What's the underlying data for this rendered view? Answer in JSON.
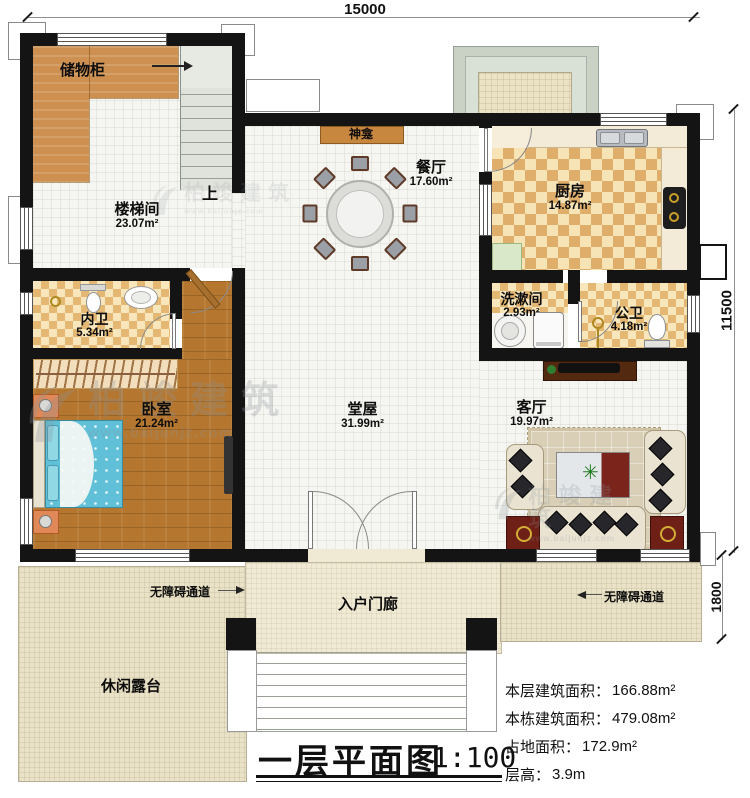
{
  "dimensions": {
    "top": "15000",
    "right": "11500",
    "porch_depth": "1800"
  },
  "rooms": {
    "storage": {
      "name": "储物柜"
    },
    "stairwell": {
      "name": "楼梯间",
      "area": "23.07m²"
    },
    "shrine": {
      "name": "神龛"
    },
    "dining": {
      "name": "餐厅",
      "area": "17.60m²"
    },
    "kitchen": {
      "name": "厨房",
      "area": "14.87m²"
    },
    "washroom": {
      "name": "洗漱间",
      "area": "2.93m²"
    },
    "public_bath": {
      "name": "公卫",
      "area": "4.18m²"
    },
    "private_bath": {
      "name": "内卫",
      "area": "5.34m²"
    },
    "bedroom": {
      "name": "卧室",
      "area": "21.24m²"
    },
    "hall": {
      "name": "堂屋",
      "area": "31.99m²"
    },
    "living": {
      "name": "客厅",
      "area": "19.97m²"
    },
    "porch": {
      "name": "入户门廊"
    },
    "terrace": {
      "name": "休闲露台"
    }
  },
  "annotations": {
    "up": "上",
    "accessible_left": "无障碍通道",
    "accessible_right": "无障碍通道"
  },
  "title_block": {
    "title": "一层平面图",
    "scale": "1:100",
    "stats": [
      {
        "label": "本层建筑面积：",
        "value": "166.88m²"
      },
      {
        "label": "本栋建筑面积：",
        "value": "479.08m²"
      },
      {
        "label": "占地面积：",
        "value": "172.9m²"
      },
      {
        "label": "层高：",
        "value": "3.9m"
      }
    ]
  },
  "watermark": {
    "brand": "柏竣建筑",
    "url": "www.baijunjz.com"
  },
  "colors": {
    "wall": "#141414",
    "wood_floor": "#b5772f",
    "cabinet": "#cd9050",
    "checker": "#dfae6b",
    "tile": "#f5f5f1",
    "terrace": "#eae2c6",
    "bed": "#5fc0d8",
    "accent_red": "#6e1f16",
    "stair": "#dfe3db"
  }
}
